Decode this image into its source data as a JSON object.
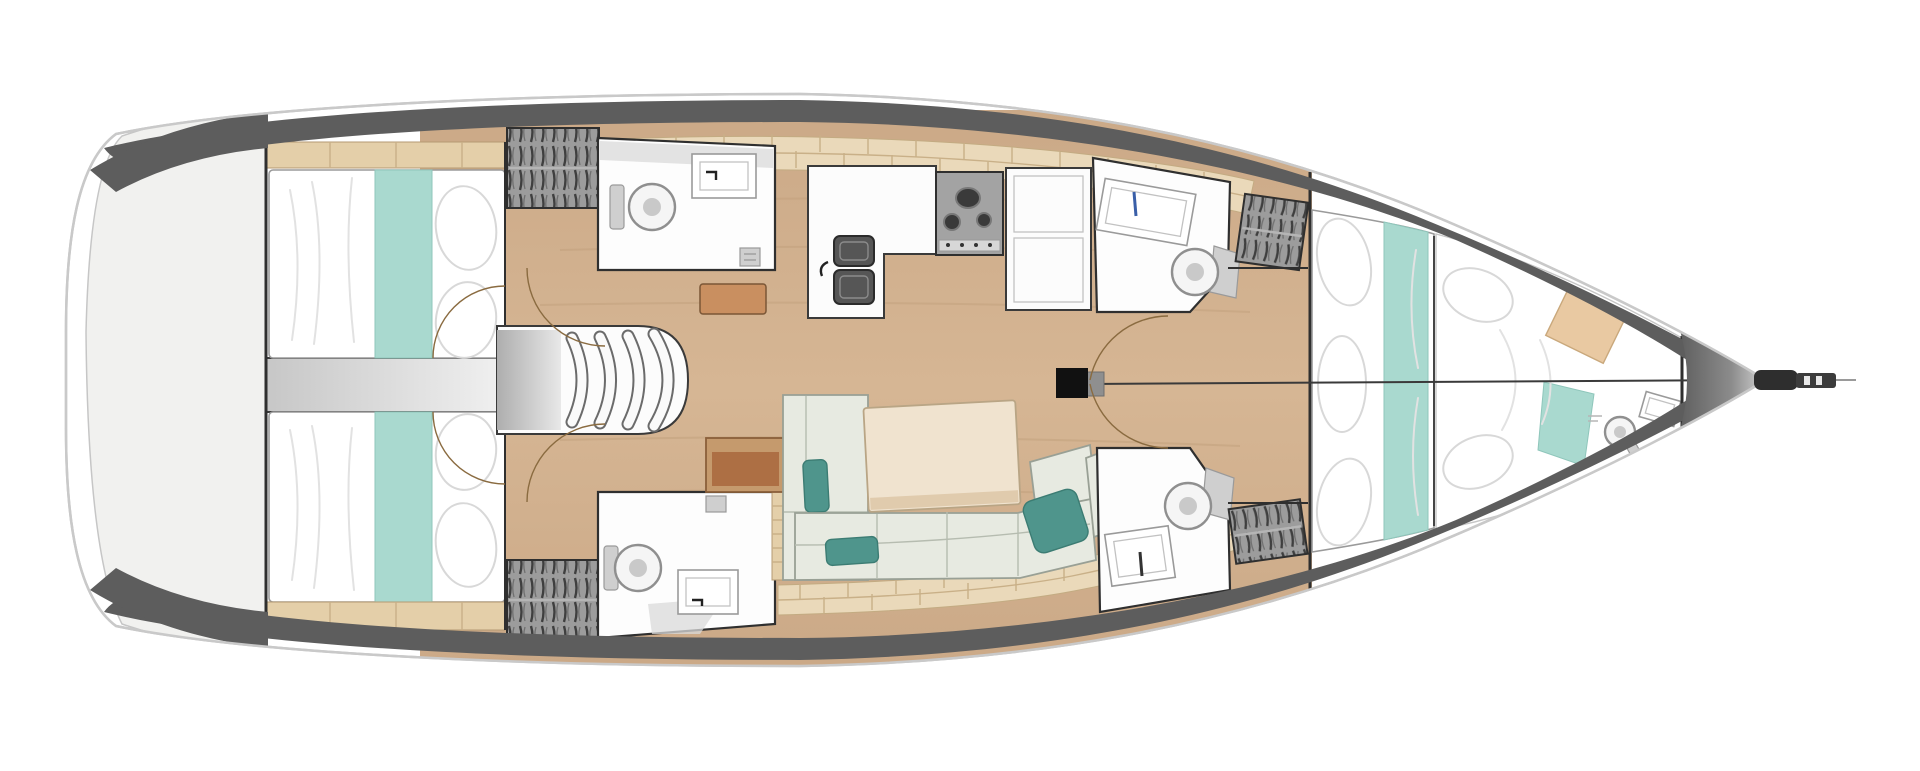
{
  "palette": {
    "background": "#ffffff",
    "hull_fill": "#ffffff",
    "hull_outline": "#c9c9c9",
    "bulwark": "#5d5d5d",
    "platform": "#f1f1ef",
    "bulkhead": "#2f2f2f",
    "room_line": "#2f2f2f",
    "sole_wood": "#cba987",
    "sole_streak": "#bf9d79",
    "shelf_wood": "#ead9ba",
    "shelf_seam": "#c9b088",
    "strip_wood": "#e4cfa9",
    "mattress": "#ffffff",
    "teal_bedding": "#a9d9cf",
    "teal_edge": "#8fc6bb",
    "teal_cushion": "#4f958c",
    "cushion_edge": "#3c7c73",
    "settee": "#e7eae1",
    "settee_line": "#99a095",
    "table_cream": "#f0e3cf",
    "table_edge": "#b9a585",
    "desk_brown": "#ad6f44",
    "desk_border": "#c59a6d",
    "shelf_brown": "#c98f60",
    "fixture_white": "#fdfdfd",
    "fixture_line": "#9a9a9a",
    "locker_base": "#9c9c9c",
    "locker_hatch": "#3f3f3f",
    "appliance_gray": "#a3a3a3",
    "sink_dark": "#565656",
    "mast_black": "#111111",
    "door_arc": "#8a6b40",
    "faucet_blue": "#3a5fa8",
    "anchor_dark": "#2e2e2e"
  },
  "features": {
    "hull": "sailboat hull, top view",
    "transom_platform": "stern swim platform",
    "aft_cabin_port": "aft double cabin, port",
    "aft_cabin_starboard": "aft double cabin, starboard",
    "companionway": "companionway entry steps",
    "head_aft_port": "aft bathroom, port",
    "head_aft_starboard": "aft bathroom, starboard",
    "galley": "galley with double sink, stove and fridge",
    "chart_table": "chart table",
    "salon": "salon settee with cushions",
    "dining_table": "salon dining table",
    "mast": "mast base",
    "head_fwd_port": "forward bathroom, port",
    "head_fwd_starboard": "forward bathroom, starboard",
    "hanging_locker": "hanging locker",
    "forward_cabin": "forward owner cabin with V-berth",
    "forepeak_cabin": "forepeak crew cabin with head",
    "bow_fitting": "bow anchor roller",
    "centerline": "centerline seam",
    "door_swing": "door swing arc"
  }
}
